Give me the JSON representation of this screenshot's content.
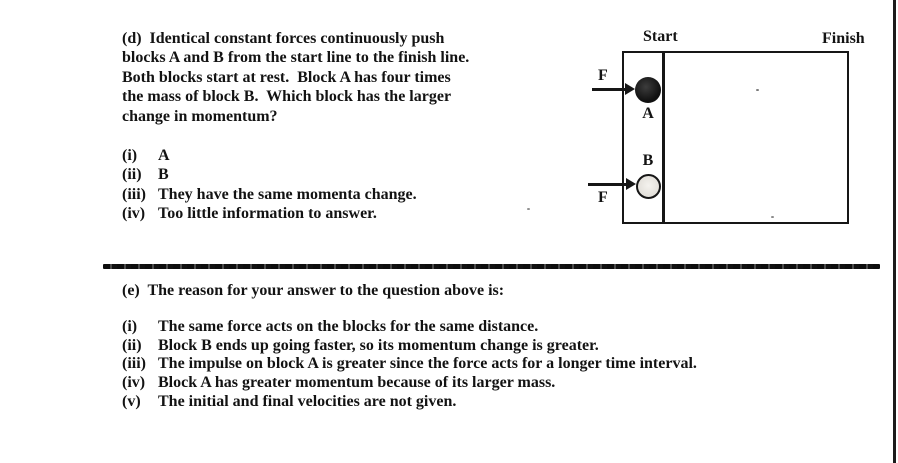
{
  "page": {
    "background_color": "#ffffff",
    "ink_color": "#131313",
    "type": "scanned physics multiple-choice question sheet"
  },
  "question_d": {
    "lines": [
      "(d)  Identical constant forces continuously push",
      "blocks A and B from the start line to the finish line.",
      "Both blocks start at rest.  Block A has four times",
      "the mass of block B.  Which block has the larger",
      "change in momentum?"
    ],
    "options": [
      {
        "numeral": "(i)",
        "text": "A"
      },
      {
        "numeral": "(ii)",
        "text": "B"
      },
      {
        "numeral": "(iii)",
        "text": "They have the same momenta change."
      },
      {
        "numeral": "(iv)",
        "text": "Too little information to answer."
      }
    ]
  },
  "diagram": {
    "start_label": "Start",
    "finish_label": "Finish",
    "block_a_label": "A",
    "block_b_label": "B",
    "force_a_label": "F",
    "force_b_label": "F"
  },
  "question_e": {
    "heading": "(e)  The reason for your answer to the question above is:",
    "options": [
      {
        "numeral": "(i)",
        "text": "The same force acts on the blocks for the same distance."
      },
      {
        "numeral": "(ii)",
        "text": "Block B ends up going faster, so its momentum change is greater."
      },
      {
        "numeral": "(iii)",
        "text": "The impulse on block A is greater since the force acts for a longer time interval."
      },
      {
        "numeral": "(iv)",
        "text": "Block A has greater momentum because of its larger mass."
      },
      {
        "numeral": "(v)",
        "text": "The initial and final velocities are not given."
      }
    ]
  }
}
